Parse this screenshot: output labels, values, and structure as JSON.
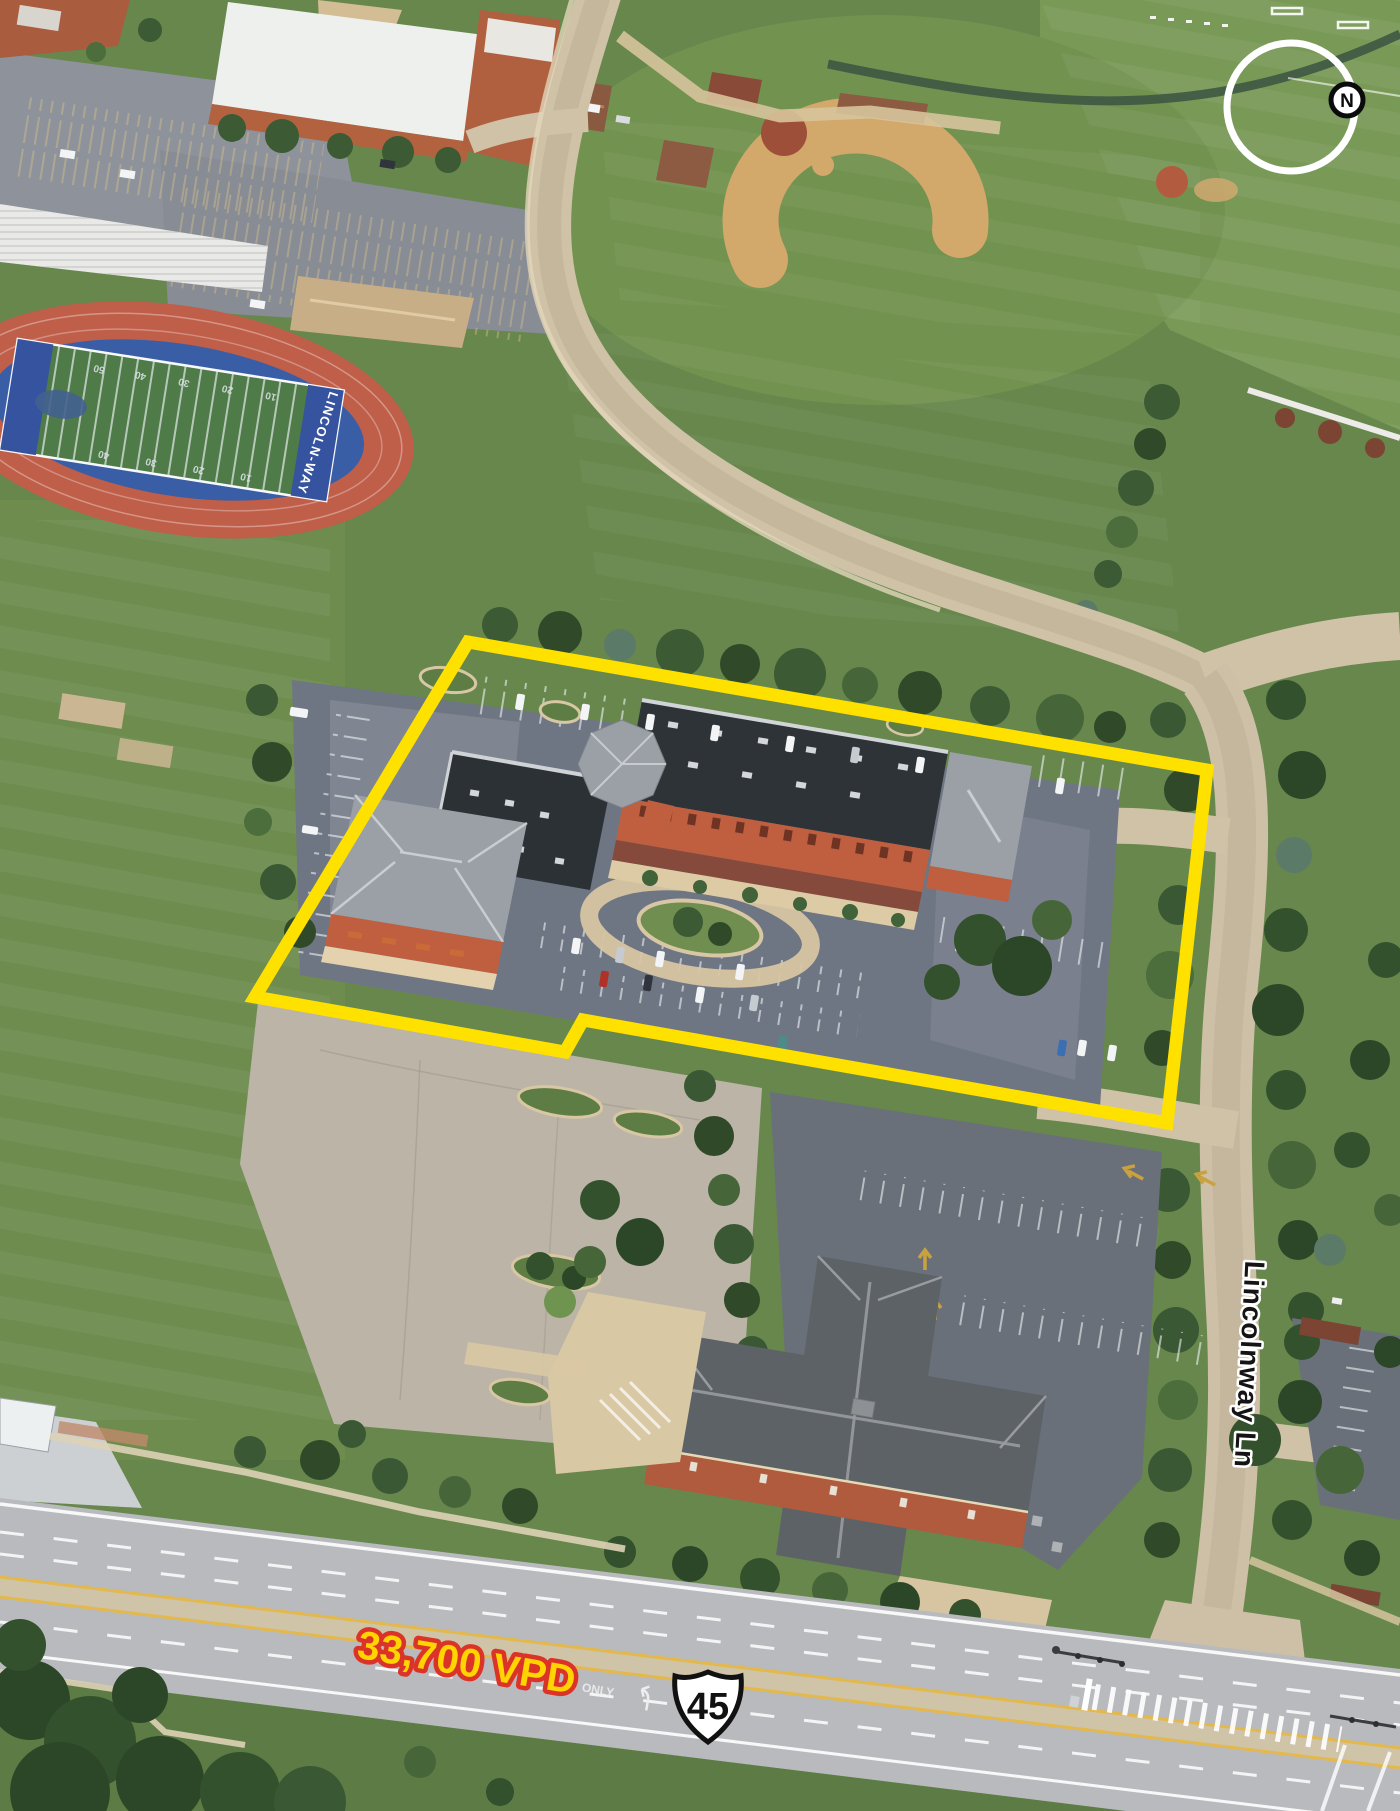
{
  "annotations": {
    "site_outline": {
      "color": "#FFE100"
    },
    "traffic_count": {
      "label": "33,700 VPD",
      "fill": "#FFD400",
      "outline": "#DC3328"
    },
    "route_shield": {
      "number": "45"
    },
    "street": {
      "label": "Lincolnway Ln"
    },
    "compass": {
      "label": "N"
    }
  },
  "ground_markings": {
    "football_team": "LINCOLN-WAY",
    "yard_numbers": [
      "50",
      "40",
      "30",
      "20",
      "10"
    ],
    "lane_marking": "ONLY"
  },
  "palette": {
    "grass": "#67874d",
    "asphalt": "#6f7683",
    "roof_dark": "#2e3338",
    "brick": "#bf5f40",
    "road_tan": "#cdc0a6",
    "highway_gray": "#b8babe",
    "track_red": "#bf5e49",
    "field_blue": "#3a5ea6"
  }
}
